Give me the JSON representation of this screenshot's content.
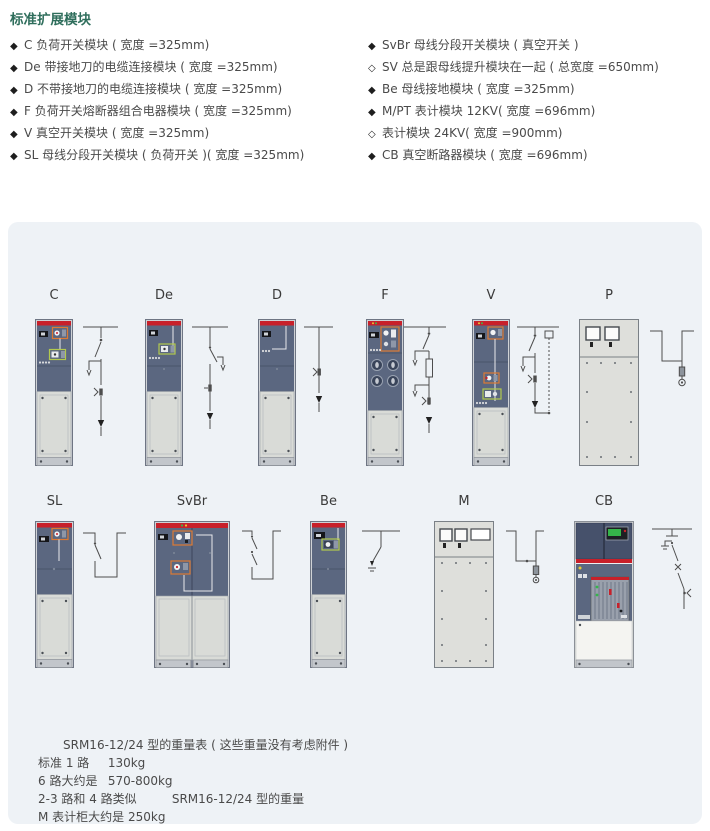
{
  "title": "标准扩展模块",
  "bullet_lists": {
    "left": [
      {
        "bullet": "◆",
        "text": "C 负荷开关模块 ( 宽度 =325mm)"
      },
      {
        "bullet": "◆",
        "text": "De 带接地刀的电缆连接模块 ( 宽度 =325mm)"
      },
      {
        "bullet": "◆",
        "text": "D 不带接地刀的电缆连接模块 ( 宽度 =325mm)"
      },
      {
        "bullet": "◆",
        "text": "F 负荷开关熔断器组合电器模块 ( 宽度 =325mm)"
      },
      {
        "bullet": "◆",
        "text": "V 真空开关模块 ( 宽度 =325mm)"
      },
      {
        "bullet": "◆",
        "text": "SL 母线分段开关模块 ( 负荷开关 )( 宽度 =325mm)"
      }
    ],
    "right": [
      {
        "bullet": "◆",
        "text": "SvBr 母线分段开关模块 ( 真空开关 )"
      },
      {
        "bullet": "◇",
        "text": "SV 总是跟母线提升模块在一起 ( 总宽度 =650mm)"
      },
      {
        "bullet": "◆",
        "text": "Be 母线接地模块 ( 宽度 =325mm)"
      },
      {
        "bullet": "◆",
        "text": "M/PT 表计模块 12KV( 宽度 =696mm)"
      },
      {
        "bullet": "◇",
        "text": "表计模块 24KV( 宽度 =900mm)"
      },
      {
        "bullet": "◆",
        "text": "CB 真空断路器模块 ( 宽度 =696mm)"
      }
    ]
  },
  "modules": {
    "row1": [
      "C",
      "De",
      "D",
      "F",
      "V",
      "P"
    ],
    "row2": [
      "SL",
      "SvBr",
      "Be",
      "M",
      "CB"
    ]
  },
  "weights": {
    "title": "SRM16-12/24 型的重量表 ( 这些重量没有考虑附件 )",
    "rows": [
      {
        "label": "标准 1 路",
        "value": "130kg"
      },
      {
        "label": "6 路大约是",
        "value": "570-800kg"
      },
      {
        "label": "2-3 路和 4 路类似",
        "value": "SRM16-12/24 型的重量"
      },
      {
        "label": "M 表计柜大约是 250kg",
        "value": ""
      }
    ]
  },
  "colors": {
    "accent_red": "#c8202a",
    "title_green": "#2f6e5c",
    "panel_bg": "#eef2f6",
    "cabinet_dark": "#5b6780",
    "cabinet_light": "#d9dbd7"
  }
}
